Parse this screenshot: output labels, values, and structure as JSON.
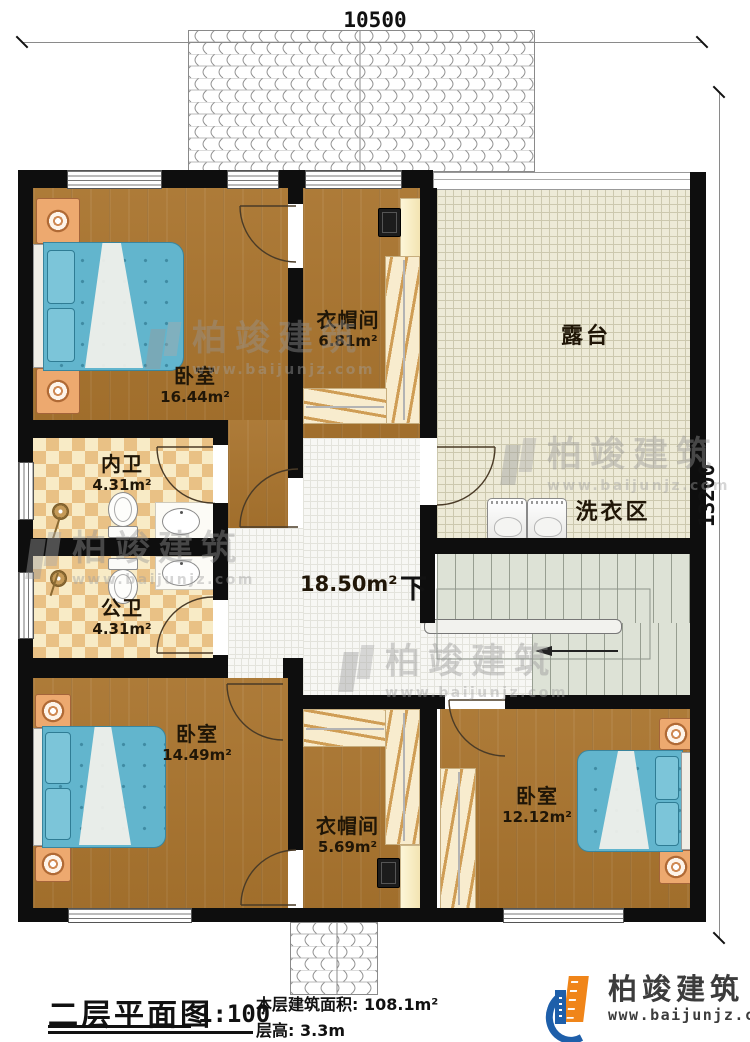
{
  "dimensions": {
    "top": "10500",
    "right": "13200"
  },
  "rooms": {
    "bedroom1": {
      "name": "卧室",
      "area": "16.44m²"
    },
    "cloakroom1": {
      "name": "衣帽间",
      "area": "6.81m²"
    },
    "terrace": {
      "name": "露台"
    },
    "laundry": {
      "name": "洗衣区"
    },
    "inner_bath": {
      "name": "内卫",
      "area": "4.31m²"
    },
    "public_bath": {
      "name": "公卫",
      "area": "4.31m²"
    },
    "hall": {
      "area": "18.50m²",
      "stairs_down": "下"
    },
    "bedroom2": {
      "name": "卧室",
      "area": "14.49m²"
    },
    "cloakroom2": {
      "name": "衣帽间",
      "area": "5.69m²"
    },
    "bedroom3": {
      "name": "卧室",
      "area": "12.12m²"
    }
  },
  "footer": {
    "title": "二层平面图",
    "scale": "1:100",
    "floor_area_label": "本层建筑面积:",
    "floor_area_value": "108.1m²",
    "floor_height_label": "层高:",
    "floor_height_value": "3.3m"
  },
  "brand": {
    "name": "柏竣建筑",
    "website": "www.baijunjz.com"
  },
  "watermark": {
    "name": "柏竣建筑",
    "website": "www.baijunjz.com"
  },
  "colors": {
    "wall": "#0e0e0e",
    "wood": "#a9742e",
    "terrace_tile": "#edead7",
    "hall_tile": "#f7f7f4",
    "stairs": "#dde2d6",
    "bath_tile": "#e9c185",
    "mattress": "#62b5cd",
    "brand_blue": "#1e5faa",
    "brand_orange": "#f08519"
  }
}
